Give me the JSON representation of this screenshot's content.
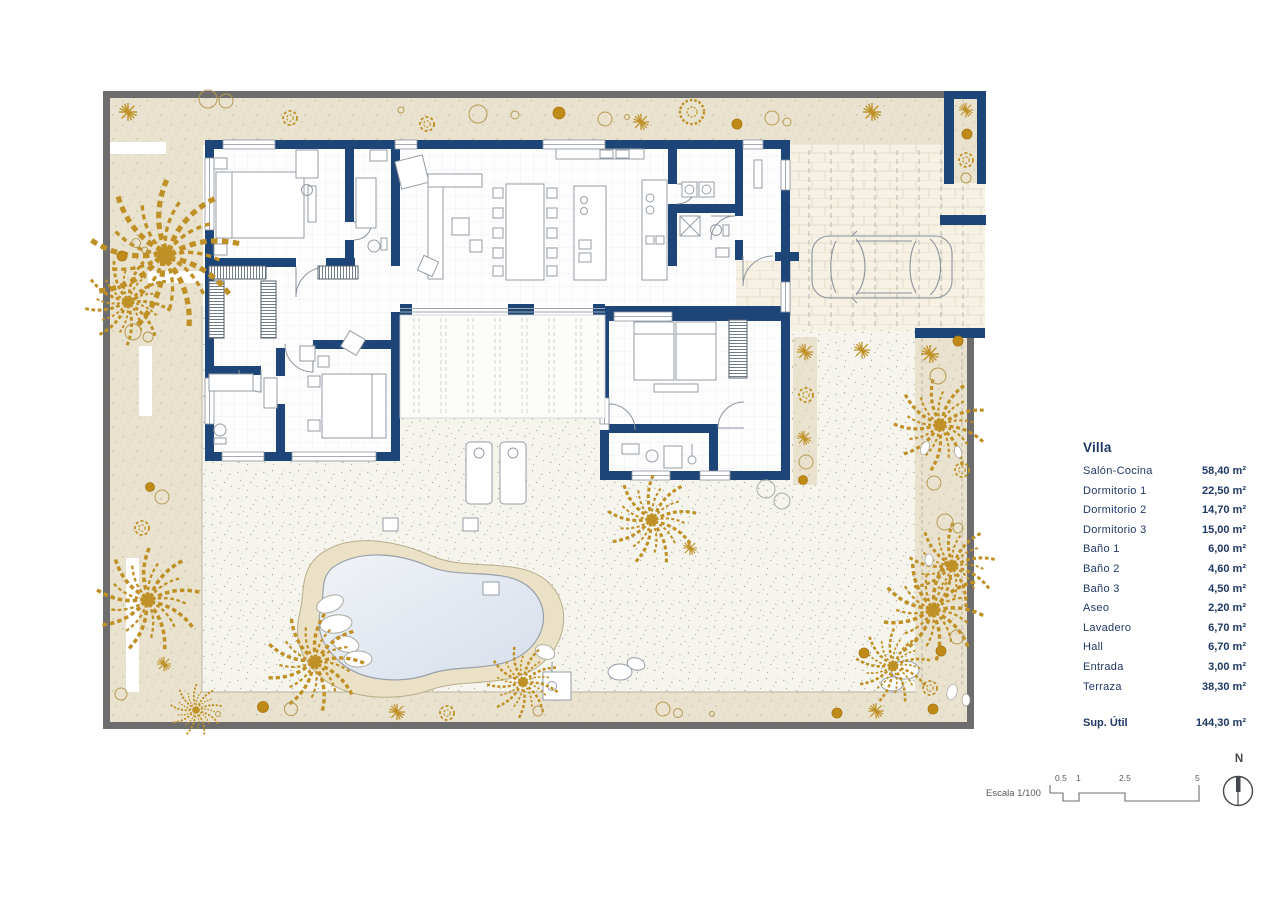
{
  "legend": {
    "heading": "Villa",
    "rows": [
      {
        "label": "Salón-Cocina",
        "value": "58,40 m²"
      },
      {
        "label": "Dormitorio 1",
        "value": "22,50 m²"
      },
      {
        "label": "Dormitorio 2",
        "value": "14,70 m²"
      },
      {
        "label": "Dormitorio 3",
        "value": "15,00 m²"
      },
      {
        "label": "Baño 1",
        "value": "6,00 m²"
      },
      {
        "label": "Baño 2",
        "value": "4,60 m²"
      },
      {
        "label": "Baño 3",
        "value": "4,50 m²"
      },
      {
        "label": "Aseo",
        "value": "2,20 m²"
      },
      {
        "label": "Lavadero",
        "value": "6,70 m²"
      },
      {
        "label": "Hall",
        "value": "6,70 m²"
      },
      {
        "label": "Entrada",
        "value": "3,00 m²"
      },
      {
        "label": "Terraza",
        "value": "38,30 m²"
      }
    ],
    "total": {
      "label": "Sup. Útil",
      "value": "144,30 m²"
    }
  },
  "scale_bar": {
    "label": "Escala 1/100",
    "ticks": [
      "0.5",
      "1",
      "2.5",
      "5"
    ]
  },
  "north": {
    "label": "N"
  },
  "colors": {
    "wall_navy": "#1d4578",
    "frame_gray": "#6d6d6d",
    "garden_beige": "#e9e2ce",
    "terrace_speckle": "#f5f5ee",
    "plant_gold": "#bf9026",
    "legend_text": "#1f3864",
    "pool_water": "#dde4ee"
  }
}
